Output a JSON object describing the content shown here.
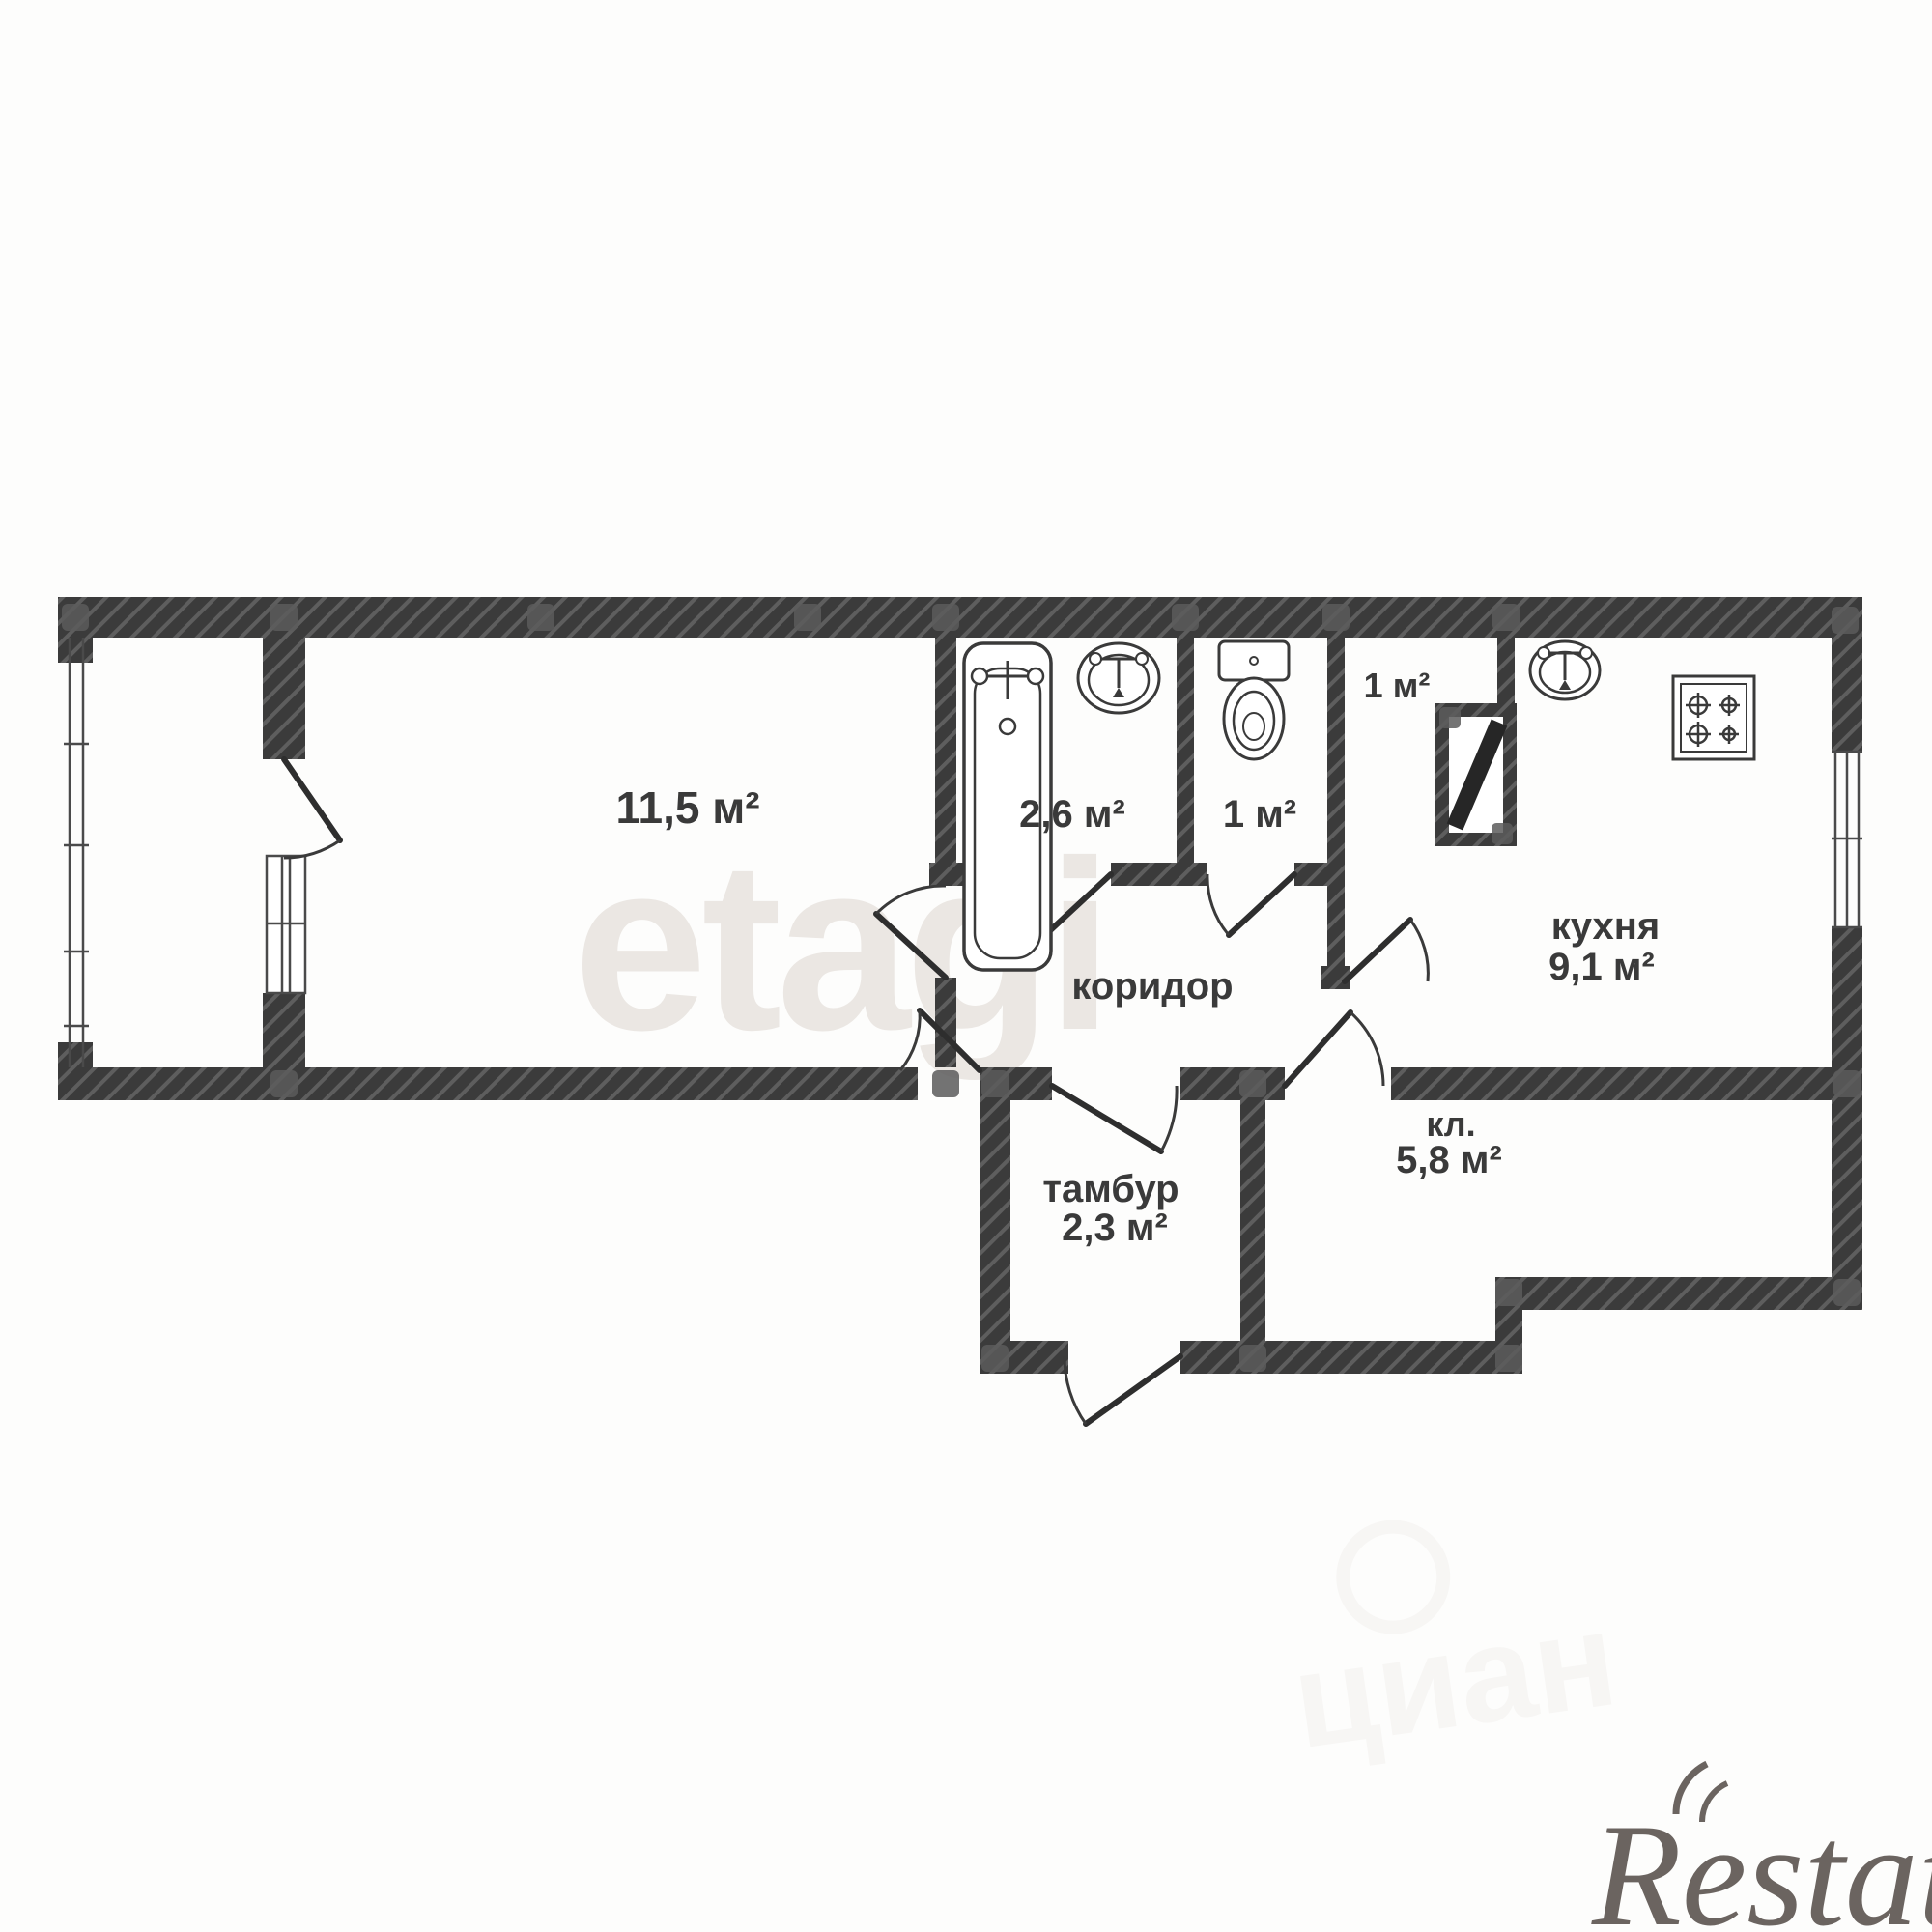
{
  "plan": {
    "title": "apartment-floor-plan",
    "rooms": [
      {
        "id": "living-room",
        "area": "11,5 м²"
      },
      {
        "id": "bathroom",
        "area": "2,6 м²"
      },
      {
        "id": "toilet",
        "area": "1 м²"
      },
      {
        "id": "closet",
        "area": "1 м²"
      },
      {
        "id": "kitchen",
        "name": "кухня",
        "area": "9,1 м²"
      },
      {
        "id": "corridor",
        "name": "коридор"
      },
      {
        "id": "tambour",
        "name": "тамбур",
        "area": "2,3 м²"
      },
      {
        "id": "storage",
        "name": "кл.",
        "area": "5,8 м²"
      }
    ],
    "fixtures": [
      "bathtub",
      "bath-sink",
      "toilet",
      "vent-shaft",
      "kitchen-sink",
      "stove"
    ],
    "watermarks": {
      "agency": "etagi",
      "portal": "циан",
      "brand": "Restate"
    },
    "colors": {
      "wall": "#3b3b3b",
      "wall_hatch": "#5e5e5e",
      "label": "#3a3a3a",
      "watermark_agency": "#ebe7e3",
      "watermark_portal": "#f3f1ef",
      "watermark_brand": "#6b6460",
      "background": "#fdfdfc"
    }
  }
}
